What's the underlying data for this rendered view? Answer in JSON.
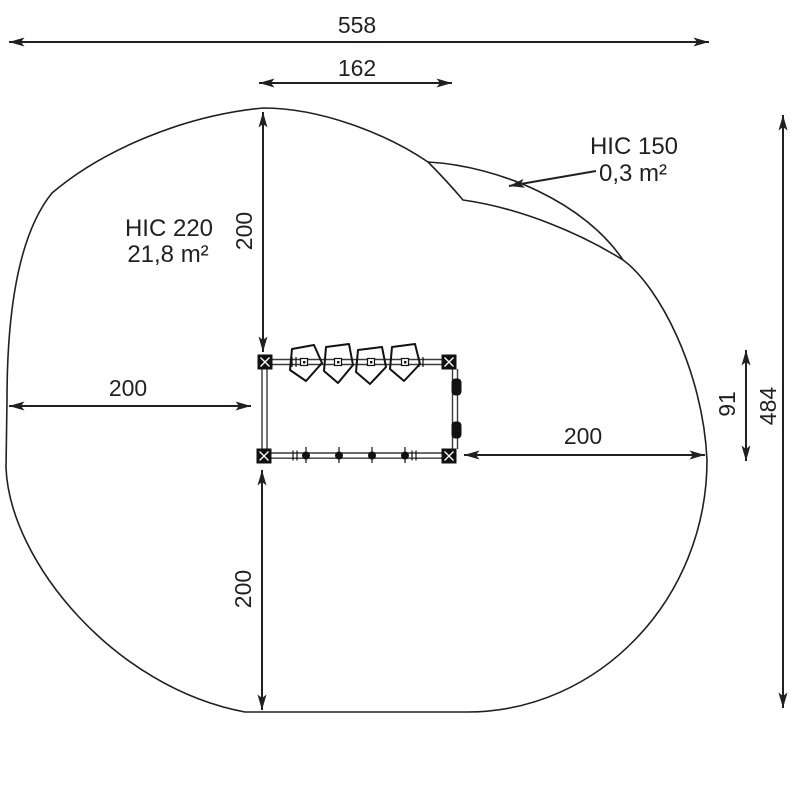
{
  "diagram": {
    "title": "playground-safety-zone-plan",
    "colors": {
      "ink": "#231f20",
      "background": "#ffffff"
    },
    "dimensions": {
      "total_width": "558",
      "upper_inner_width": "162",
      "top_clearance": "200",
      "left_clearance": "200",
      "right_clearance": "200",
      "bottom_clearance": "200",
      "equipment_depth": "91",
      "total_height": "484"
    },
    "zones": {
      "hic220": {
        "title": "HIC 220",
        "area": "21,8 m²"
      },
      "hic150": {
        "title": "HIC 150",
        "area": "0,3 m²"
      }
    }
  }
}
